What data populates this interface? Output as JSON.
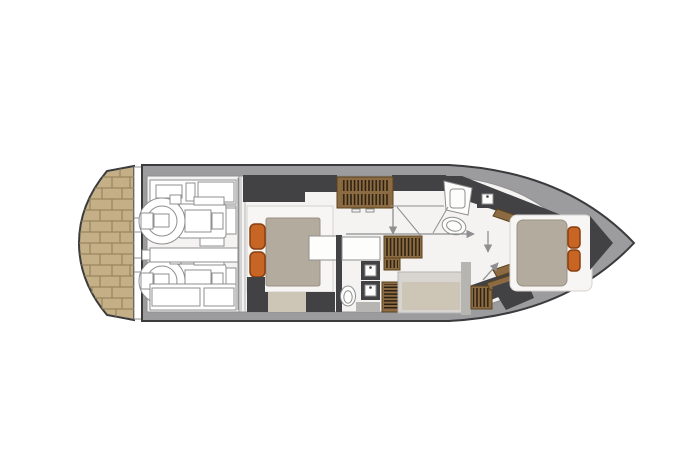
{
  "palette": {
    "background": "#ffffff",
    "hull_gray": "#9c9b9d",
    "outline_dark": "#3b3b3d",
    "wall_charcoal": "#424144",
    "floor_white": "#f4f3f1",
    "line_gray": "#8f8f91",
    "thin_gray": "#b4b3b5",
    "teak": "#c4af86",
    "teak_line": "#917e57",
    "mattress_gray": "#b3ab9d",
    "mattress_edge": "#9a9182",
    "bench_beige": "#cdc5b5",
    "pillow_orange": "#c66524",
    "pillow_edge": "#8a3f10",
    "wood_brown": "#8c6b43",
    "wood_dark": "#5a431f",
    "tread_dark": "#2a1f10",
    "fixture_white": "#f7f6f4",
    "fixture_edge": "#d5d3cf",
    "frame_gray": "#d8d5d0",
    "gray_strip": "#b7b5b1"
  },
  "components": [
    {
      "name": "swim-platform",
      "pattern": "teak-planks"
    },
    {
      "name": "engine-room",
      "engines": 2
    },
    {
      "name": "master-cabin",
      "orange_cushions": 2,
      "beds": 1
    },
    {
      "name": "master-head",
      "sinks": 2,
      "toilets": 1
    },
    {
      "name": "salon-staircase",
      "tread_rows": 2
    },
    {
      "name": "companionway-stairs",
      "tread_rows": 2
    },
    {
      "name": "forward-head",
      "showers": 1,
      "sinks": 1,
      "toilets": 1
    },
    {
      "name": "vip-cabin",
      "orange_cushions": 2,
      "beds": 1
    },
    {
      "name": "guest-berth",
      "berths": 1
    },
    {
      "name": "door-swing-arrows",
      "arrows": 4
    }
  ]
}
